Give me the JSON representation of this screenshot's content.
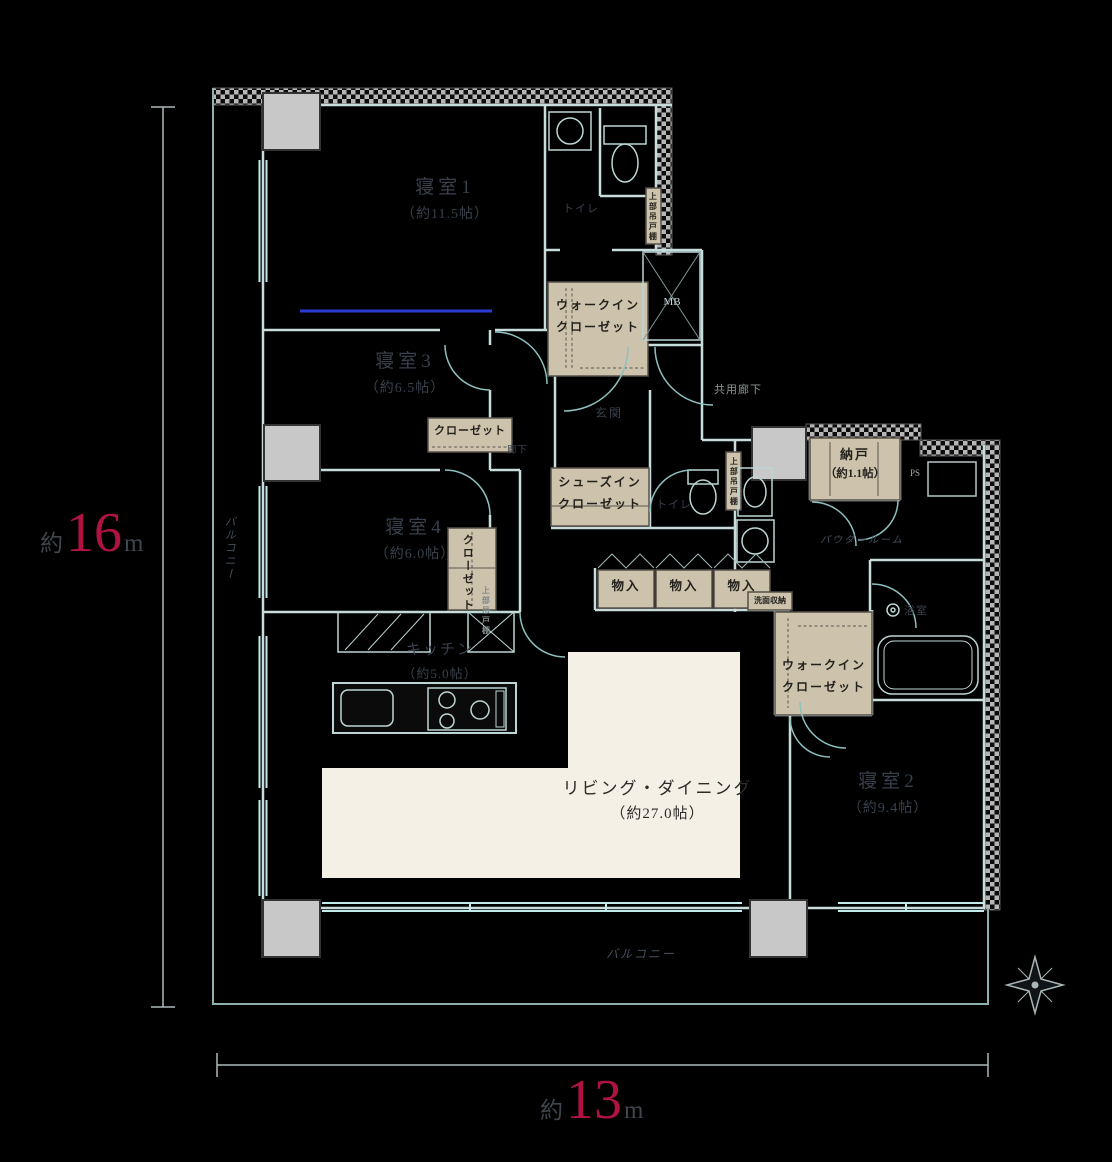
{
  "palette": {
    "accent": "#b01341",
    "closet_beige": "#cdc3ad",
    "living_cream": "#f4f0e6"
  },
  "dimensions": {
    "left": {
      "prefix": "約",
      "value": "16",
      "unit": "m"
    },
    "bottom": {
      "prefix": "約",
      "value": "13",
      "unit": "m"
    }
  },
  "rooms": {
    "bedroom1": {
      "name": "寝室1",
      "size": "（約11.5帖）"
    },
    "bedroom2": {
      "name": "寝室2",
      "size": "（約9.4帖）"
    },
    "bedroom3": {
      "name": "寝室3",
      "size": "（約6.5帖）"
    },
    "bedroom4": {
      "name": "寝室4",
      "size": "（約6.0帖）"
    },
    "kitchen": {
      "name": "キッチン",
      "size": "（約5.0帖）"
    },
    "living": {
      "name": "リビング・ダイニング",
      "size": "（約27.0帖）"
    },
    "storage_room": {
      "name": "納戸",
      "size": "（約1.1帖）"
    }
  },
  "closets": {
    "walk_in_1": {
      "line1": "ウォークイン",
      "line2": "クローゼット"
    },
    "walk_in_2": {
      "line1": "ウォークイン",
      "line2": "クローゼット"
    },
    "shoes_in": {
      "line1": "シューズイン",
      "line2": "クローゼット"
    },
    "closet_1": "クローゼット",
    "closet_2": "クローゼット"
  },
  "labels": {
    "storage1": "物入",
    "storage2": "物入",
    "storage3": "物入",
    "washstand_storage": "洗面収納",
    "toilet1": "トイレ",
    "toilet2": "トイレ",
    "entrance": "玄関",
    "bathroom": "浴室",
    "powder_room": "パウダールーム",
    "hallway": "廊下",
    "shared_corridor": "共用廊下",
    "balcony_left": "バルコニー",
    "balcony_bottom": "バルコニー",
    "meter_box": "MB",
    "pipe_space": "PS",
    "upper_cabinet_1": "上部吊戸棚",
    "upper_cabinet_2": "上部吊戸棚",
    "upper_cabinet_3": "上部吊戸棚"
  }
}
